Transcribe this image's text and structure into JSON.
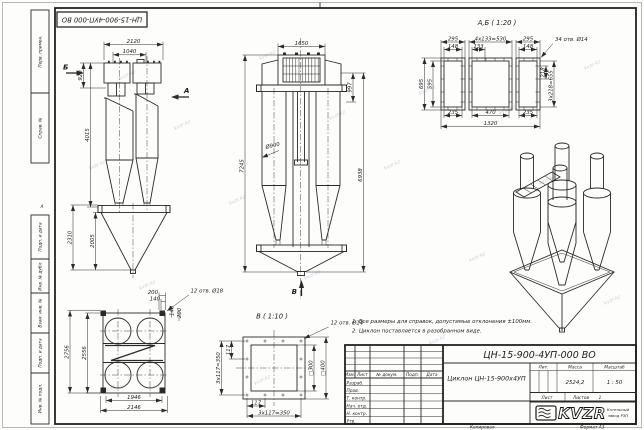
{
  "watermark": {
    "text": "kvzr.kz"
  },
  "stamp": {
    "designation_inverted": "ЦН-15-900-4УП-000 ВО"
  },
  "margin": {
    "labels": [
      "Перв. примен.",
      "Справ. №",
      "Подп. и дата",
      "Инв. № дубл.",
      "Взам. инв. №",
      "Подп. и дата",
      "Инв. № подл."
    ],
    "zone": "А",
    "copy_label": "Копировал",
    "format_label": "Формат А3"
  },
  "views": {
    "side": {
      "label_b": "Б",
      "label_a": "А",
      "dim_2120": "2120",
      "dim_1040": "1040",
      "dim_920": "920",
      "dim_4015": "4015",
      "dim_2310": "2310",
      "dim_2005": "2005"
    },
    "front": {
      "label_v": "В",
      "dim_1650": "1650",
      "dim_997": "997",
      "dim_7245": "7245",
      "dim_6938": "6938",
      "dim_d900": "Ø900"
    },
    "plan": {
      "dim_200t": "200",
      "dim_140t": "140",
      "holes": "12 отв. Ø18",
      "dim_140r": "140",
      "dim_200r": "200",
      "dim_2756": "2756",
      "dim_2556": "2556",
      "dim_1946": "1946",
      "dim_2146": "2146"
    },
    "detail_ab": {
      "title": "А,Б ( 1:20 )",
      "holes": "34 отв. Ø14",
      "dim_295l": "295",
      "dim_530": "4х133=530",
      "dim_295r": "295",
      "dim_148l": "148",
      "dim_133": "133",
      "dim_148r": "148",
      "dim_695": "695",
      "dim_595": "595",
      "dim_218": "218",
      "dim_655": "3х218=655",
      "dim_235l": "235",
      "dim_470": "470",
      "dim_235r": "235",
      "dim_1320": "1320"
    },
    "detail_v": {
      "title": "В ( 1:10 )",
      "holes": "12 отв. Ø14",
      "dim_300": "□300",
      "dim_400": "□400",
      "dim_117b": "117",
      "dim_350b": "3х117=350",
      "dim_117l": "117",
      "dim_350l": "3х117=350"
    }
  },
  "notes": [
    "1. Все размеры для справок, допустимые отклонения ±100мм.",
    "2. Циклон поставляется в разобранном виде."
  ],
  "title_block": {
    "designation": "ЦН-15-900-4УП-000 ВО",
    "name": "Циклон ЦН-15-900х4УП",
    "columns": {
      "izm": "Изм.",
      "list": "Лист",
      "doc": "№ докум.",
      "podp": "Подп.",
      "data": "Дата"
    },
    "rows": [
      "Разраб.",
      "Пров.",
      "Т. контр.",
      "Нач. отд.",
      "Н. контр.",
      "Утв."
    ],
    "lit_label": "Лит.",
    "mass_label": "Масса",
    "scale_label": "Масштаб",
    "mass_value": "2524,2",
    "scale_value": "1 : 50",
    "sheet_label": "Лист",
    "sheets_label": "Листов",
    "sheets_value": "1",
    "logo_text": "KVZR",
    "company_line1": "Котельный",
    "company_line2": "завод РЗП"
  }
}
